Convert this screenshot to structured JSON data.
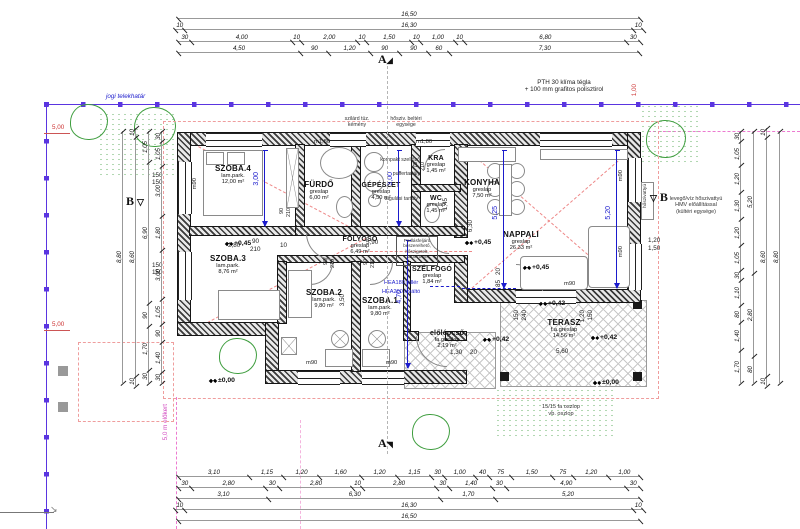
{
  "boundary": {
    "label": "jogi telekhatár",
    "front_yard_label": "5,0 m előkert"
  },
  "markers": {
    "a": "A",
    "b": "B",
    "tri": "▽"
  },
  "notes": {
    "wall1": "PTH 30 klíma tégla",
    "wall2": "+ 100 mm grafitos polisztirol",
    "chimney": "szilárd tüz. kémény",
    "indoor_unit": "hősziv. beltéri egysége",
    "vent": "kompakt szellőző",
    "buffer_tank": "puffertartály",
    "exp_tank": "tágulási tartály",
    "attic": "Padlásfeljáró beszerelhető, hőszigetelt, 110x70cm",
    "hea_pillar": "HEA180 pillér",
    "hea_lintel": "HEA200 kiváltó",
    "posts1": "15/15 fa oszlop",
    "posts2": "vb. oszlop",
    "heat_pump_box": "hőszivattyú",
    "heat_pump1": "levegő/víz hőszivattyú",
    "heat_pump2": "HMV előállítással",
    "heat_pump3": "(kültéri egysége)"
  },
  "levels": {
    "l045": "+0,45",
    "l042": "+0,42",
    "l000": "±0,00"
  },
  "parapets": {
    "p90": "m90",
    "p180": "m1,80"
  },
  "rooms": {
    "szoba4": {
      "name": "SZOBA.4",
      "floor": "lam.park.",
      "area": "12,00 m²"
    },
    "furdo": {
      "name": "FÜRDŐ",
      "floor": "greslap",
      "area": "6,00 m²"
    },
    "gepeszet": {
      "name": "GÉPÉSZET",
      "floor": "greslap",
      "area": "4,50 m²"
    },
    "kra": {
      "name": "KRA",
      "floor": "greslap",
      "area": "1,45 m²"
    },
    "wc": {
      "name": "WC",
      "floor": "greslap",
      "area": "1,45 m²"
    },
    "konyha": {
      "name": "KONYHA",
      "floor": "greslap",
      "area": "7,50 m²"
    },
    "nappali": {
      "name": "NAPPALI",
      "floor": "greslap",
      "area": "26,33 m²"
    },
    "folyoso": {
      "name": "FOLYOSÓ",
      "floor": "greslap",
      "area": "6,49 m²"
    },
    "szoba3": {
      "name": "SZOBA.3",
      "floor": "lam.park.",
      "area": "8,76 m²"
    },
    "szoba2": {
      "name": "SZOBA.2",
      "floor": "lam.park.",
      "area": "9,80 m²"
    },
    "szoba1": {
      "name": "SZOBA.1",
      "floor": "lam.park.",
      "area": "9,80 m²"
    },
    "szelfogo": {
      "name": "SZÉLFOGÓ",
      "floor": "greslap",
      "area": "1,84 m²"
    },
    "elolepcso": {
      "name": "előlépcső",
      "floor": "fa.greslap",
      "area": "2,19 m²"
    },
    "terasz": {
      "name": "TERASZ",
      "floor": "f.a.greslap",
      "area": "14,56 m²"
    }
  },
  "dims": {
    "top": [
      [
        "16,50"
      ],
      [
        "10",
        "16,30",
        "10"
      ],
      [
        "30",
        "4,00",
        "10",
        "2,00",
        "10",
        "1,50",
        "10",
        "1,00",
        "10",
        "6,80",
        "30"
      ],
      [
        "4,50",
        "90",
        "1,20",
        "90",
        "90",
        "60",
        "7,30"
      ]
    ],
    "bottom": [
      [
        "3,10",
        "1,15",
        "1,20",
        "1,60",
        "1,20",
        "1,15",
        "30",
        "1,00",
        "40",
        "75",
        "1,50",
        "75",
        "1,20",
        "1,00"
      ],
      [
        "30",
        "2,80",
        "30",
        "2,80",
        "10",
        "2,80",
        "30",
        "1,40",
        "30",
        "4,90",
        "30"
      ],
      [
        "3,10",
        "6,30",
        "1,70",
        "5,20"
      ],
      [
        "10",
        "16,30",
        "10"
      ],
      [
        "16,50"
      ]
    ],
    "left": [
      [
        "8,80"
      ],
      [
        "10",
        "8,60",
        "10"
      ],
      [
        "1,05",
        "6,90",
        "90",
        "1,70",
        "30"
      ],
      [
        "30",
        "1,05",
        "3,00",
        "1,80",
        "3,00",
        "1,05",
        "90",
        "1,40",
        "30"
      ]
    ],
    "right": [
      [
        "30",
        "1,05",
        "1,20",
        "1,30",
        "1,20",
        "1,05",
        "30",
        "1,10",
        "80",
        "1,40",
        "1,70"
      ],
      [
        "5,20",
        "2,80",
        "80"
      ],
      [
        "10",
        "8,60",
        "10"
      ],
      [
        "8,80"
      ]
    ],
    "red5": "5,00",
    "red100": "1,00",
    "blue": {
      "szoba4": "3,00",
      "furdo": "3,00",
      "folyoso": "4,70",
      "konyha": "5,25",
      "nappali": "5,20"
    },
    "vals": {
      "v10": "10",
      "v20": "20",
      "v30": "30",
      "v75": "75",
      "v85": "85",
      "v90": "90",
      "v120": "1,20",
      "v130": "1,30",
      "v145": "1,45",
      "c150": "150",
      "m150": "1,50",
      "v210": "210",
      "v240": "240",
      "v280": "2,80",
      "v350": "3,50",
      "v560": "5,60",
      "v590": "5,90",
      "v630": "6,30"
    }
  }
}
